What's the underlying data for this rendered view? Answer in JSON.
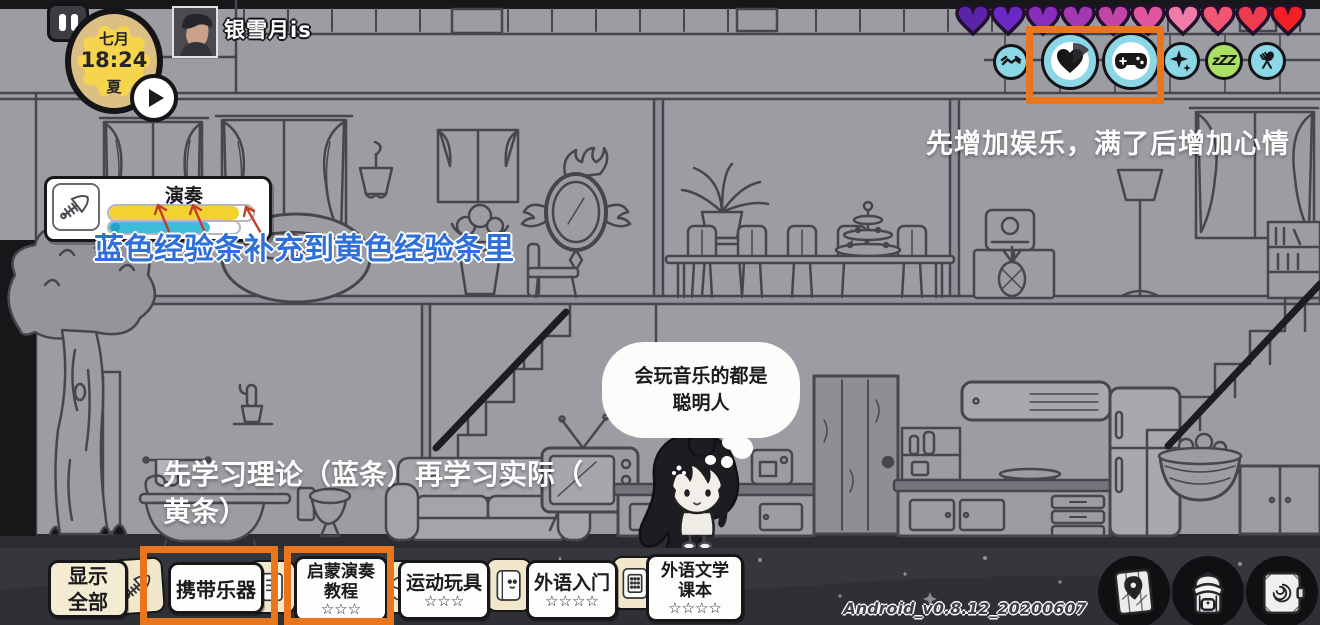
{
  "app": {
    "version_text": "Android_v0.8.12_20200607"
  },
  "clock": {
    "month_label": "七月",
    "time": "18:24",
    "season_label": "夏"
  },
  "player": {
    "name": "银雪月is"
  },
  "hearts": {
    "count": 10,
    "colors": [
      "#5a23a8",
      "#6b28c4",
      "#8a2dbd",
      "#a438b2",
      "#c244a6",
      "#e0559c",
      "#f07ba8",
      "#f25672",
      "#ee3b4e",
      "#f21f24"
    ]
  },
  "status": {
    "sleep_label": "zZZ",
    "icons": [
      "handshake",
      "mood-heart",
      "entertainment-gamepad",
      "sparkle",
      "sleep-zzz",
      "food-cutlery"
    ]
  },
  "tutorial": {
    "top_hint": "先增加娱乐，满了后增加心情",
    "xp_hint": "蓝色经验条补充到黄色经验条里",
    "learn_hint": "先学习理论（蓝条）再学习实际（\n黄条）"
  },
  "skill": {
    "title": "演奏",
    "yellow_pct": 90,
    "blue_pct": 78,
    "yellow_color": "#f2d32e",
    "blue_color": "#3dbdd9"
  },
  "speech": {
    "text": "会玩音乐的都是\n聪明人"
  },
  "toolbar": {
    "show_all_label": "显示\n全部",
    "items": [
      {
        "label": "携带乐器",
        "stars": ""
      },
      {
        "label": "启蒙演奏\n教程",
        "stars": "☆☆☆"
      },
      {
        "label": "运动玩具",
        "stars": "☆☆☆"
      },
      {
        "label": "外语入门",
        "stars": "☆☆☆☆"
      },
      {
        "label": "外语文学\n课本",
        "stars": "☆☆☆☆"
      }
    ]
  },
  "bottom_right_icons": [
    "map",
    "backpack",
    "journal"
  ],
  "colors": {
    "accent_orange": "#e9751d",
    "wall_gray": "#9c9ca3",
    "status_cyan": "#8bd7e6",
    "sleep_green": "#abe163"
  }
}
